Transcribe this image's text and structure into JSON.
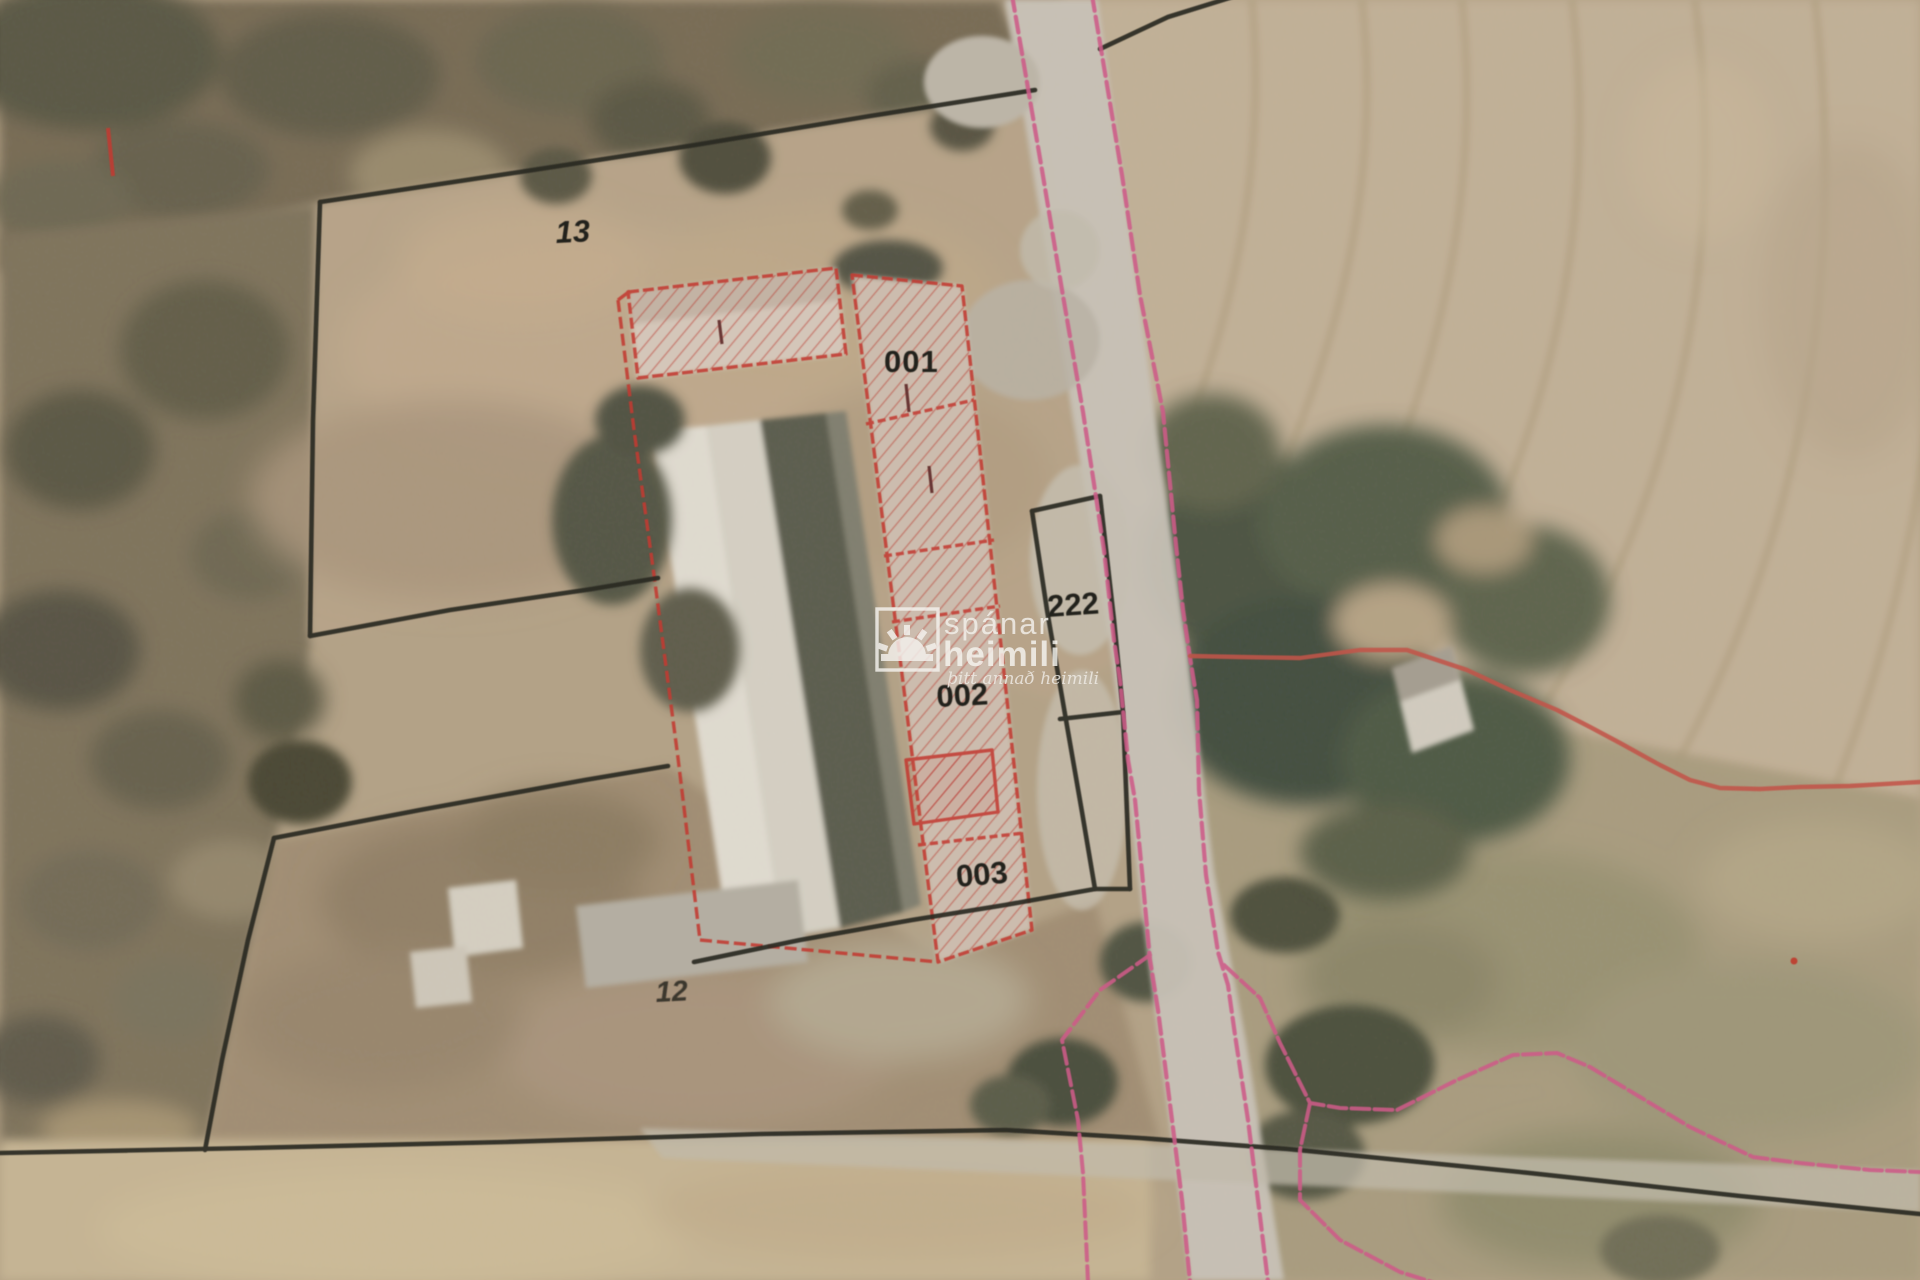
{
  "map": {
    "type": "aerial-cadastral-plan",
    "labels": [
      {
        "id": "parcel-13",
        "text": "13"
      },
      {
        "id": "unit-001",
        "text": "001"
      },
      {
        "id": "parcel-222",
        "text": "222"
      },
      {
        "id": "unit-002",
        "text": "002"
      },
      {
        "id": "unit-003",
        "text": "003"
      },
      {
        "id": "parcel-12",
        "text": "12"
      }
    ],
    "watermark": {
      "brand_top": "spánar",
      "brand_bottom": "heimili",
      "tagline": "þitt annað heimili"
    },
    "colors": {
      "boundary_black": "#2c2923",
      "road_pink": "#cd5c88",
      "building_red": "#c23b31",
      "field_curve_red": "#c2544a",
      "road_surface": "#c9c3b8",
      "field_light": "#c2b096",
      "scrub_dark": "#55523f"
    }
  }
}
